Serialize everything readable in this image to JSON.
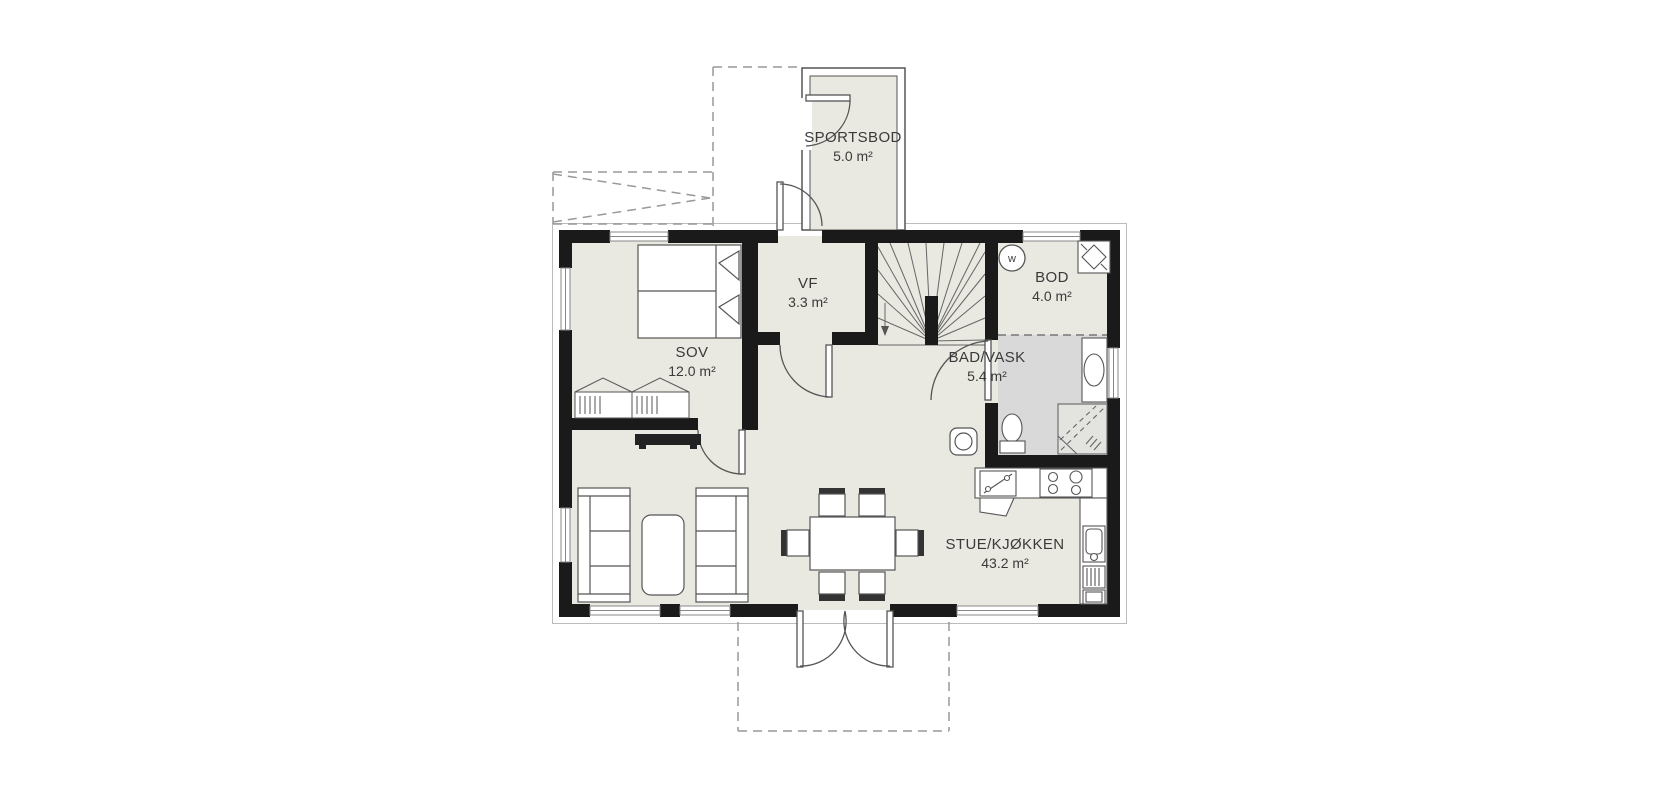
{
  "plan": {
    "rooms": [
      {
        "id": "sportsbod",
        "name": "SPORTSBOD",
        "area": "5.0 m²"
      },
      {
        "id": "sov",
        "name": "SOV",
        "area": "12.0 m²"
      },
      {
        "id": "vf",
        "name": "VF",
        "area": "3.3 m²"
      },
      {
        "id": "bod",
        "name": "BOD",
        "area": "4.0 m²"
      },
      {
        "id": "bad",
        "name": "BAD/VASK",
        "area": "5.4 m²"
      },
      {
        "id": "stue",
        "name": "STUE/KJØKKEN",
        "area": "43.2 m²"
      }
    ],
    "symbols": {
      "washing_machine_label": "w"
    },
    "colors": {
      "wall": "#1a1a1a",
      "floor": "#e9e8e1",
      "bathroom_floor": "#d9d9d9",
      "furniture_line": "#555555",
      "dashed_outline": "#999999"
    }
  }
}
